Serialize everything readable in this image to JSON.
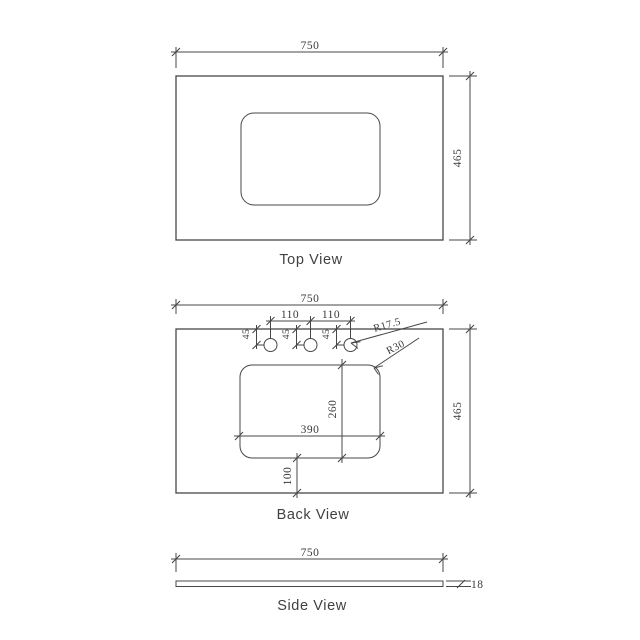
{
  "colors": {
    "line": "#474747",
    "dim_text": "#3a3a3a",
    "label_text": "#414141",
    "background": "#ffffff"
  },
  "top_view": {
    "label": "Top View",
    "dims": {
      "width": "750",
      "depth": "465"
    }
  },
  "back_view": {
    "label": "Back View",
    "dims": {
      "width": "750",
      "depth": "465",
      "hole_spacing_left": "110",
      "hole_spacing_right": "110",
      "hole_offsets": [
        "45",
        "45",
        "45"
      ],
      "hole_radius": "R17.5",
      "cutout_corner_radius": "R30",
      "cutout_width": "390",
      "cutout_depth": "260",
      "cutout_to_front": "100"
    }
  },
  "side_view": {
    "label": "Side View",
    "dims": {
      "width": "750",
      "thickness": "18"
    }
  }
}
